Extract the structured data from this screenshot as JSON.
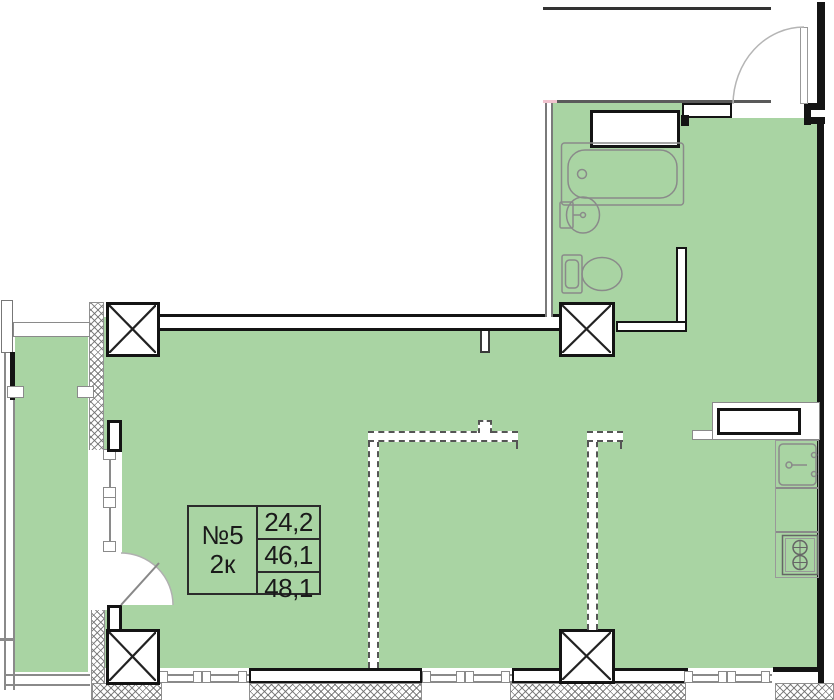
{
  "plan": {
    "unit": {
      "number": "№5",
      "rooms_label": "2к",
      "area_values": [
        "24,2",
        "46,1",
        "48,1"
      ]
    },
    "colors": {
      "room_fill": "#a9d4a3",
      "wall": "#141414",
      "thin_line": "#8a8a8a",
      "dashed_partition": "#555555",
      "accent_pink": "#f2c3cf"
    },
    "fixtures": [
      "bathtub",
      "wash-basin",
      "toilet",
      "kitchen-sink",
      "stove",
      "ventilation-shaft",
      "entry-door",
      "balcony-door"
    ],
    "columns_count": 4
  }
}
